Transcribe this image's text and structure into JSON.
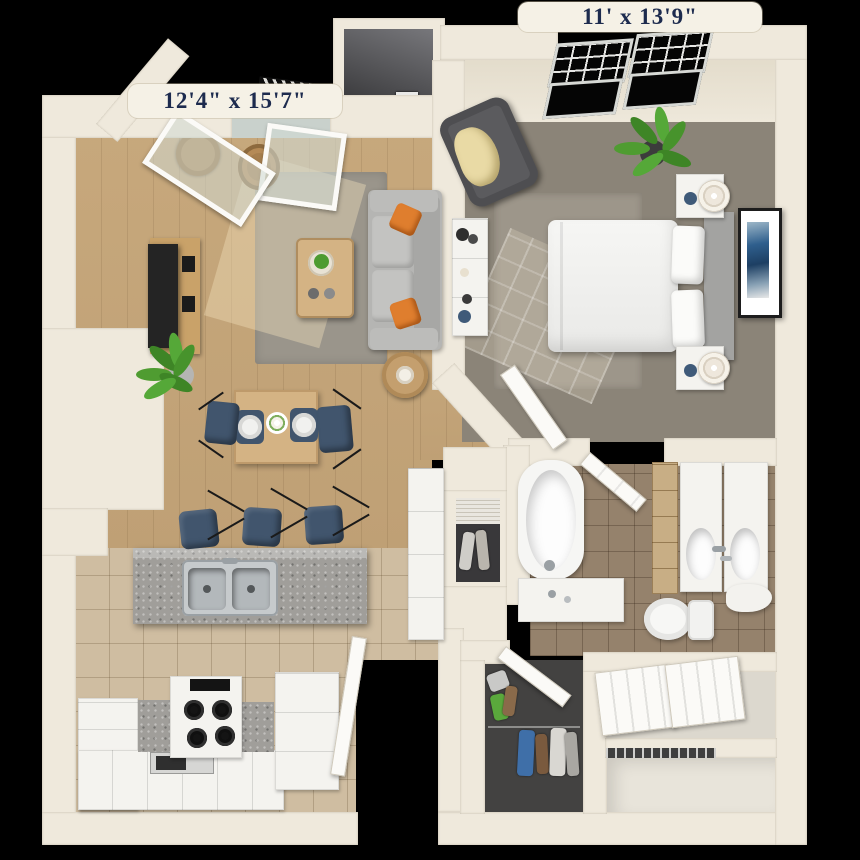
{
  "labels": {
    "living_room": "12'4\" x 15'7\"",
    "bedroom": "11' x 13'9\""
  },
  "colors": {
    "background": "#000000",
    "wall": "#efe9dc",
    "label_bg": "#f5f1e6",
    "label_text": "#1d2b4e",
    "wood_floor": "#c7a87c",
    "living_rug": "#9a958b",
    "carpet": "#8b8478",
    "bedroom_rug": "#9d968a",
    "kitchen_tile": "#cfbda1",
    "bath_tile": "#95826c",
    "granite": "#a09e9a",
    "stainless": "#c6cacc",
    "white_furniture": "#f4f3ef",
    "sofa": "#b5b5b3",
    "pillow_orange": "#df7e2e",
    "navy_blue": "#41556d",
    "table_wood": "#d4b384",
    "plant_green": "#4d9b31",
    "tv_black": "#242424",
    "art_blue": "#2f5f8d",
    "closet_interior": "#434241",
    "door_white": "#fbfaf7",
    "balcony_dark": "#47474a"
  }
}
